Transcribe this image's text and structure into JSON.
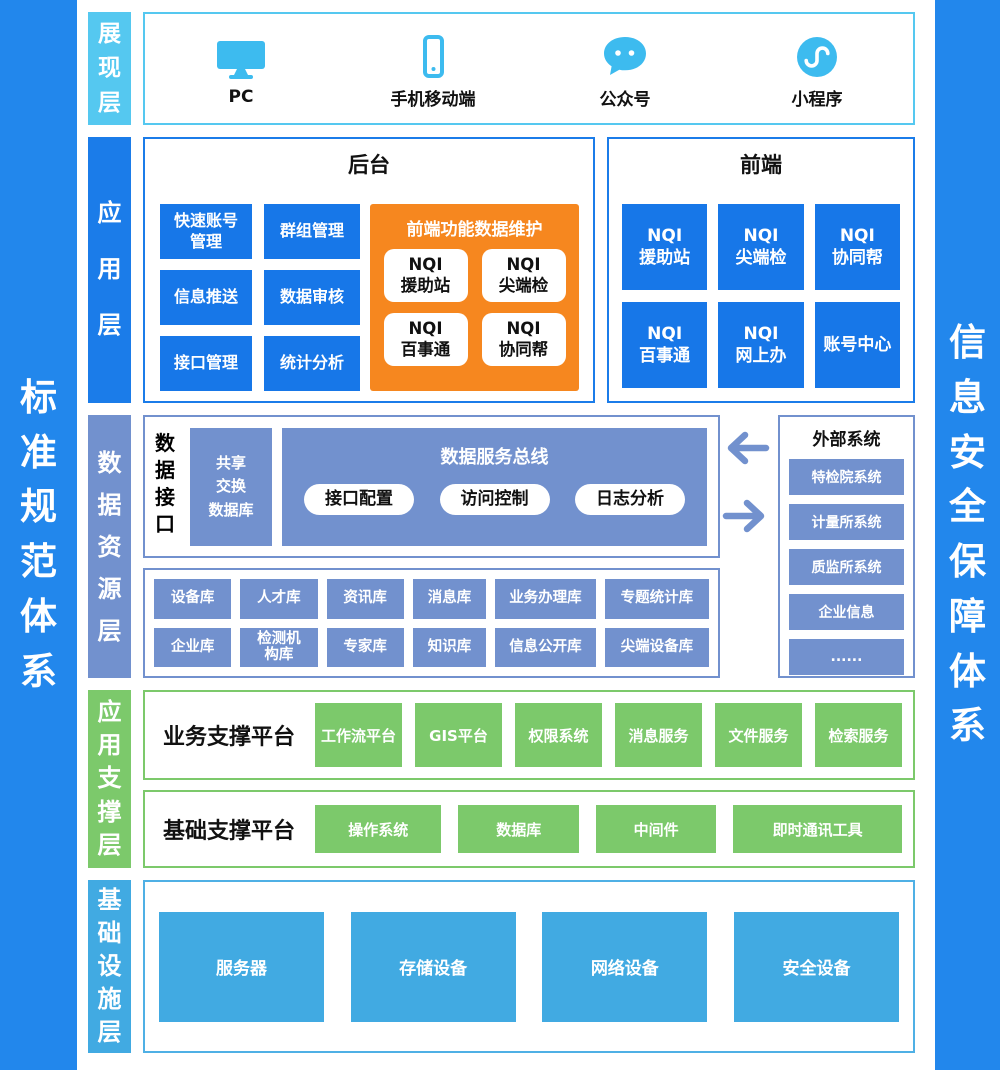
{
  "sidebars": {
    "left": "标准规范体系",
    "right": "信息安全保障体系"
  },
  "layers": {
    "presentation": {
      "tab": "展现层",
      "items": [
        {
          "icon": "pc-icon",
          "label": "PC"
        },
        {
          "icon": "mobile-icon",
          "label": "手机移动端"
        },
        {
          "icon": "official-account-icon",
          "label": "公众号"
        },
        {
          "icon": "mini-program-icon",
          "label": "小程序"
        }
      ]
    },
    "application": {
      "tab": "应用层",
      "backend": {
        "title": "后台",
        "modules": [
          "快速账号\n管理",
          "群组管理",
          "信息推送",
          "数据审核",
          "接口管理",
          "统计分析"
        ],
        "maintenance": {
          "title": "前端功能数据维护",
          "modules": [
            "NQI\n援助站",
            "NQI\n尖端检",
            "NQI\n百事通",
            "NQI\n协同帮"
          ]
        }
      },
      "frontend": {
        "title": "前端",
        "modules": [
          "NQI\n援助站",
          "NQI\n尖端检",
          "NQI\n协同帮",
          "NQI\n百事通",
          "NQI\n网上办",
          "账号中心"
        ]
      }
    },
    "data_resource": {
      "tab": "数据资源层",
      "data_interface": {
        "label": "数据接口",
        "shared_db": "共享\n交换\n数据库",
        "service_bus": {
          "title": "数据服务总线",
          "modules": [
            "接口配置",
            "访问控制",
            "日志分析"
          ]
        }
      },
      "databases": [
        "设备库",
        "人才库",
        "资讯库",
        "消息库",
        "业务办理库",
        "专题统计库",
        "企业库",
        "检测机\n构库",
        "专家库",
        "知识库",
        "信息公开库",
        "尖端设备库"
      ],
      "external": {
        "title": "外部系统",
        "systems": [
          "特检院系统",
          "计量所系统",
          "质监所系统",
          "企业信息",
          "......"
        ]
      }
    },
    "support": {
      "tab": "应用支撑层",
      "business_platform": {
        "title": "业务支撑平台",
        "modules": [
          "工作流平台",
          "GIS平台",
          "权限系统",
          "消息服务",
          "文件服务",
          "检索服务"
        ]
      },
      "basic_platform": {
        "title": "基础支撑平台",
        "modules": [
          "操作系统",
          "数据库",
          "中间件",
          "即时通讯工具"
        ]
      }
    },
    "infrastructure": {
      "tab": "基础设施层",
      "modules": [
        "服务器",
        "存储设备",
        "网络设备",
        "安全设备"
      ]
    }
  },
  "colors": {
    "sidebar_blue": "#2287EC",
    "bright_blue": "#1777E8",
    "layer_tab_blue": "#1B7CE9",
    "cyan": "#55C8F0",
    "icon_cyan": "#3DBBEF",
    "periwinkle": "#7291CE",
    "green": "#7CC96B",
    "infra_blue": "#41AAE2",
    "orange": "#F6871F"
  }
}
